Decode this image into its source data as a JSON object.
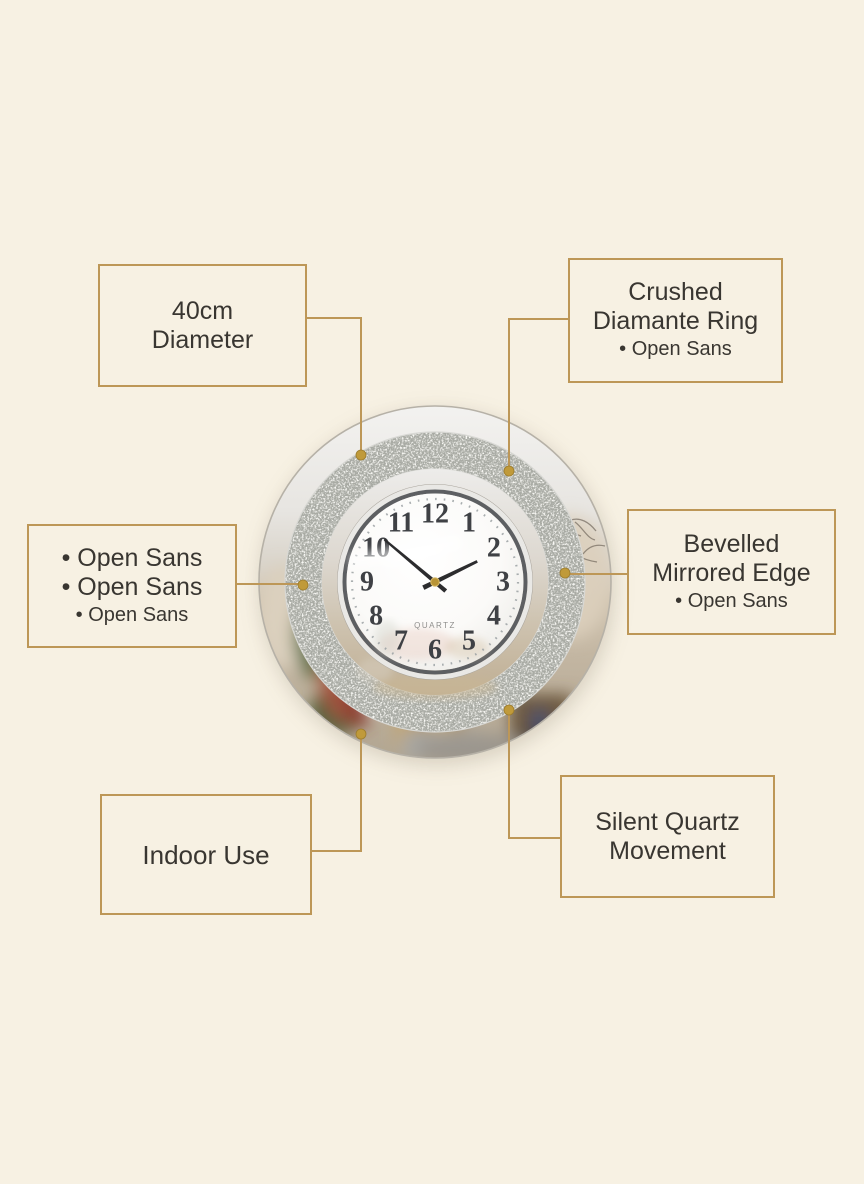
{
  "page": {
    "background_color": "#f7f1e3",
    "accent_color": "#bd9757",
    "text_color": "#393631"
  },
  "callouts": {
    "diameter": {
      "line1": "40cm",
      "line2": "Diameter"
    },
    "diamante": {
      "line1": "Crushed",
      "line2": "Diamante Ring",
      "line3": "• Open Sans"
    },
    "fonts": {
      "line1": "• Open Sans",
      "line2": "• Open Sans",
      "line3": "• Open Sans"
    },
    "bevelled": {
      "line1": "Bevelled",
      "line2": "Mirrored Edge",
      "line3": "• Open Sans"
    },
    "indoor": {
      "line1": "Indoor Use"
    },
    "movement": {
      "line1": "Silent Quartz",
      "line2": "Movement"
    }
  },
  "clock": {
    "brand_label": "QUARTZ",
    "numerals": [
      "12",
      "1",
      "2",
      "3",
      "4",
      "5",
      "6",
      "7",
      "8",
      "9",
      "10",
      "11"
    ],
    "hour_hand_transform": "rotate(64)",
    "minute_hand_transform": "rotate(310)"
  }
}
